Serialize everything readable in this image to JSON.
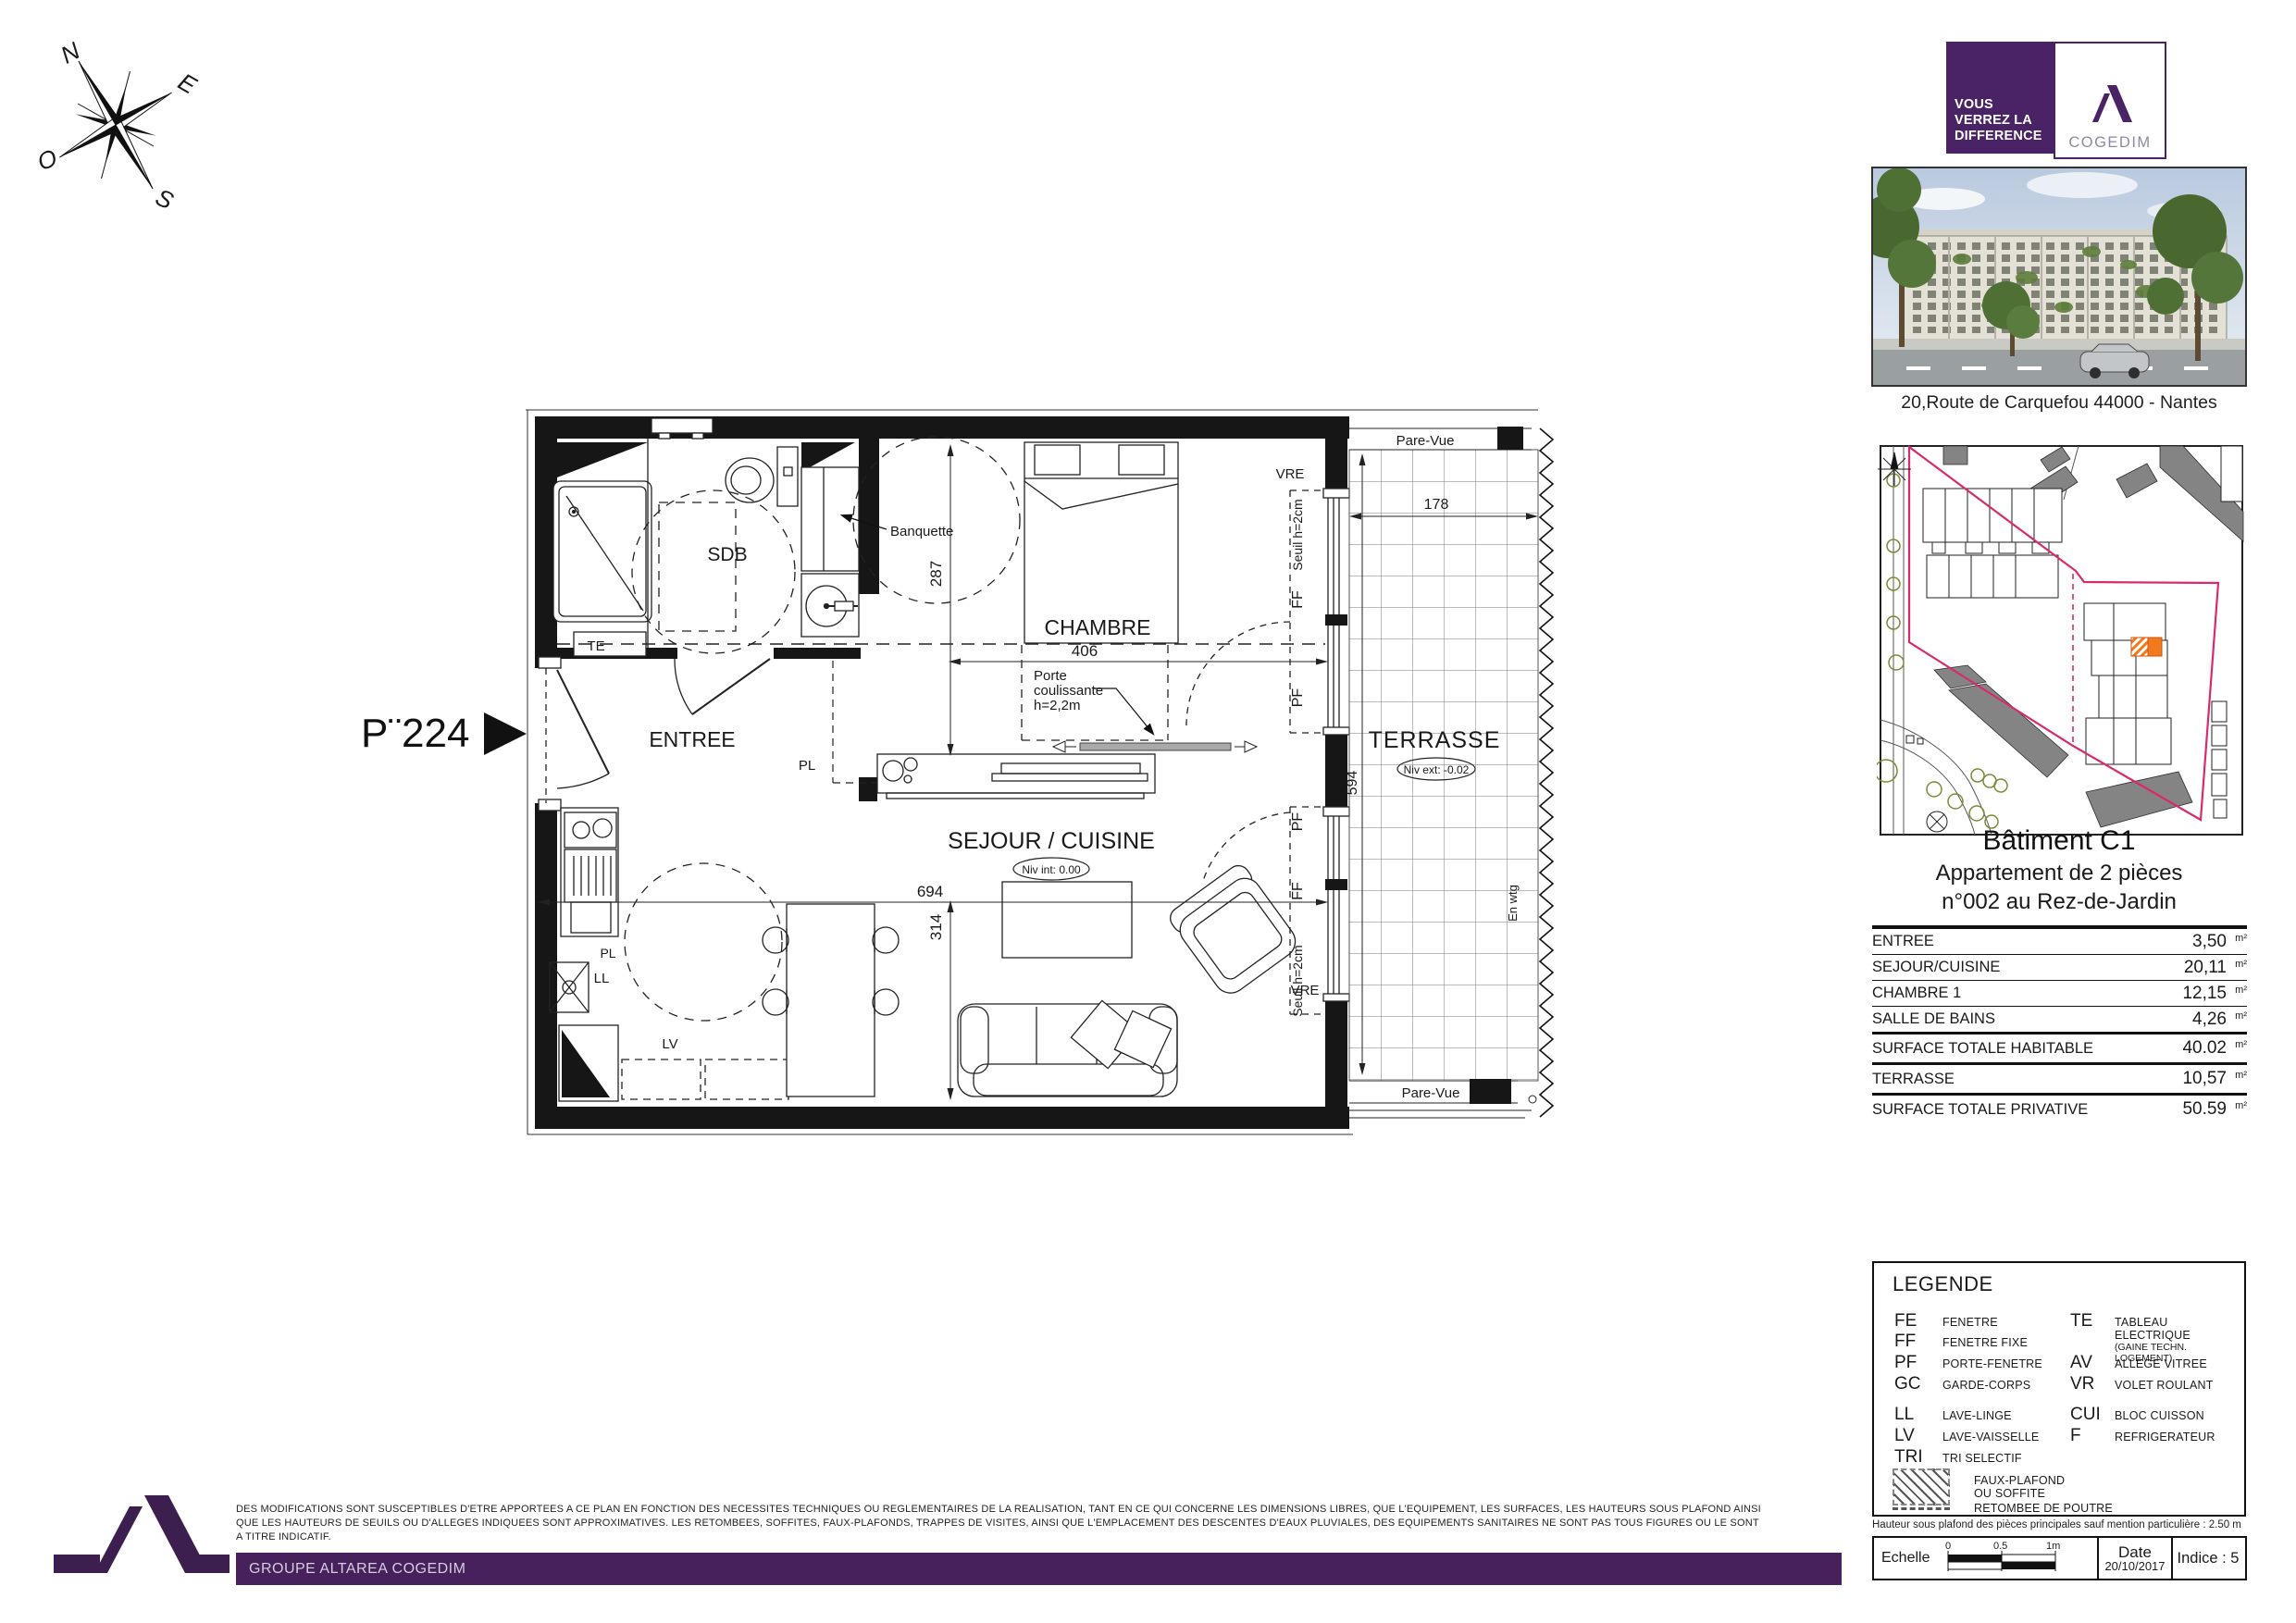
{
  "compass": {
    "n": "N",
    "e": "E",
    "s": "S",
    "o": "O"
  },
  "brand": {
    "tagline_line1": "VOUS",
    "tagline_line2": "VERREZ LA",
    "tagline_line3": "DIFFERENCE",
    "name": "COGEDIM",
    "address": "20,Route de Carquefou  44000 - Nantes"
  },
  "unit": {
    "building": "Bâtiment  C1",
    "type": "Appartement de 2 pièces",
    "number": "n°002 au Rez-de-Jardin"
  },
  "surfaces": {
    "unit_symbol": "m²",
    "rows": [
      {
        "label": "ENTREE",
        "value": "3,50"
      },
      {
        "label": "SEJOUR/CUISINE",
        "value": "20,11"
      },
      {
        "label": "CHAMBRE 1",
        "value": "12,15"
      },
      {
        "label": "SALLE DE BAINS",
        "value": "4,26"
      },
      {
        "label": "SURFACE TOTALE HABITABLE",
        "value": "40.02"
      },
      {
        "label": "TERRASSE",
        "value": "10,57"
      },
      {
        "label": "SURFACE TOTALE PRIVATIVE",
        "value": "50.59"
      }
    ]
  },
  "plan": {
    "marker": "P¨224",
    "rooms": {
      "entree": "ENTREE",
      "sdb": "SDB",
      "chambre": "CHAMBRE",
      "sejour": "SEJOUR / CUISINE",
      "terrasse": "TERRASSE"
    },
    "levels": {
      "interior": "Niv int: 0.00",
      "exterior": "Niv ext: -0.02"
    },
    "annotations": {
      "banquette": "Banquette",
      "porte": [
        "Porte",
        "coulissante",
        "h=2,2m"
      ],
      "pare_vue": "Pare-Vue",
      "seuil": "Seuil h=2cm",
      "vre": "VRE",
      "ff": "FF",
      "pf": "PF",
      "te": "TE",
      "pl": "PL",
      "ll": "LL",
      "lv": "LV",
      "misc": "En wtg"
    },
    "dimensions": {
      "chambre_width": "406",
      "chambre_height": "287",
      "sejour_width": "694",
      "sejour_height": "314",
      "terrasse_width": "178",
      "terrasse_height": "594"
    }
  },
  "legend": {
    "title": "LEGENDE",
    "col1": [
      {
        "abbr": "FE",
        "label": "FENETRE"
      },
      {
        "abbr": "FF",
        "label": "FENETRE FIXE"
      },
      {
        "abbr": "PF",
        "label": "PORTE-FENETRE"
      },
      {
        "abbr": "GC",
        "label": "GARDE-CORPS"
      },
      {
        "abbr": "LL",
        "label": "LAVE-LINGE"
      },
      {
        "abbr": "LV",
        "label": "LAVE-VAISSELLE"
      },
      {
        "abbr": "TRI",
        "label": "TRI SELECTIF"
      }
    ],
    "col2": [
      {
        "abbr": "TE",
        "label": "TABLEAU ELECTRIQUE",
        "sub": "(GAINE TECHN. LOGEMENT)"
      },
      {
        "abbr": "AV",
        "label": "ALLEGE VITREE"
      },
      {
        "abbr": "VR",
        "label": "VOLET ROULANT"
      },
      {
        "abbr": "CUI",
        "label": "BLOC CUISSON"
      },
      {
        "abbr": "F",
        "label": "REFRIGERATEUR"
      }
    ],
    "symbols": {
      "faux_plafond_line1": "FAUX-PLAFOND",
      "faux_plafond_line2": "OU SOFFITE",
      "retombee": "RETOMBEE DE POUTRE"
    }
  },
  "notes": {
    "ceiling": "Hauteur sous plafond des pièces principales sauf mention particulière : 2.50 m"
  },
  "footer": {
    "echelle": "Echelle",
    "scale_ticks": [
      "0",
      "0.5",
      "1m"
    ],
    "date_label": "Date",
    "date_value": "20/10/2017",
    "indice": "Indice : 5",
    "groupe": "GROUPE ALTAREA COGEDIM"
  },
  "disclaimer": {
    "line1": "DES MODIFICATIONS SONT SUSCEPTIBLES D'ETRE APPORTEES A CE PLAN EN FONCTION DES NECESSITES TECHNIQUES OU REGLEMENTAIRES DE LA REALISATION, TANT EN CE QUI CONCERNE LES DIMENSIONS LIBRES, QUE L'EQUIPEMENT, LES SURFACES, LES HAUTEURS SOUS PLAFOND AINSI",
    "line2": "QUE LES HAUTEURS DE SEUILS OU D'ALLEGES INDIQUEES SONT APPROXIMATIVES. LES RETOMBEES, SOFFITES, FAUX-PLAFONDS, TRAPPES DE VISITES, AINSI QUE L'EMPLACEMENT DES DESCENTES D'EAUX PLUVIALES, DES EQUIPEMENTS SANITAIRES NE SONT PAS TOUS FIGURES OU LE SONT",
    "line3": "A TITRE INDICATIF."
  }
}
